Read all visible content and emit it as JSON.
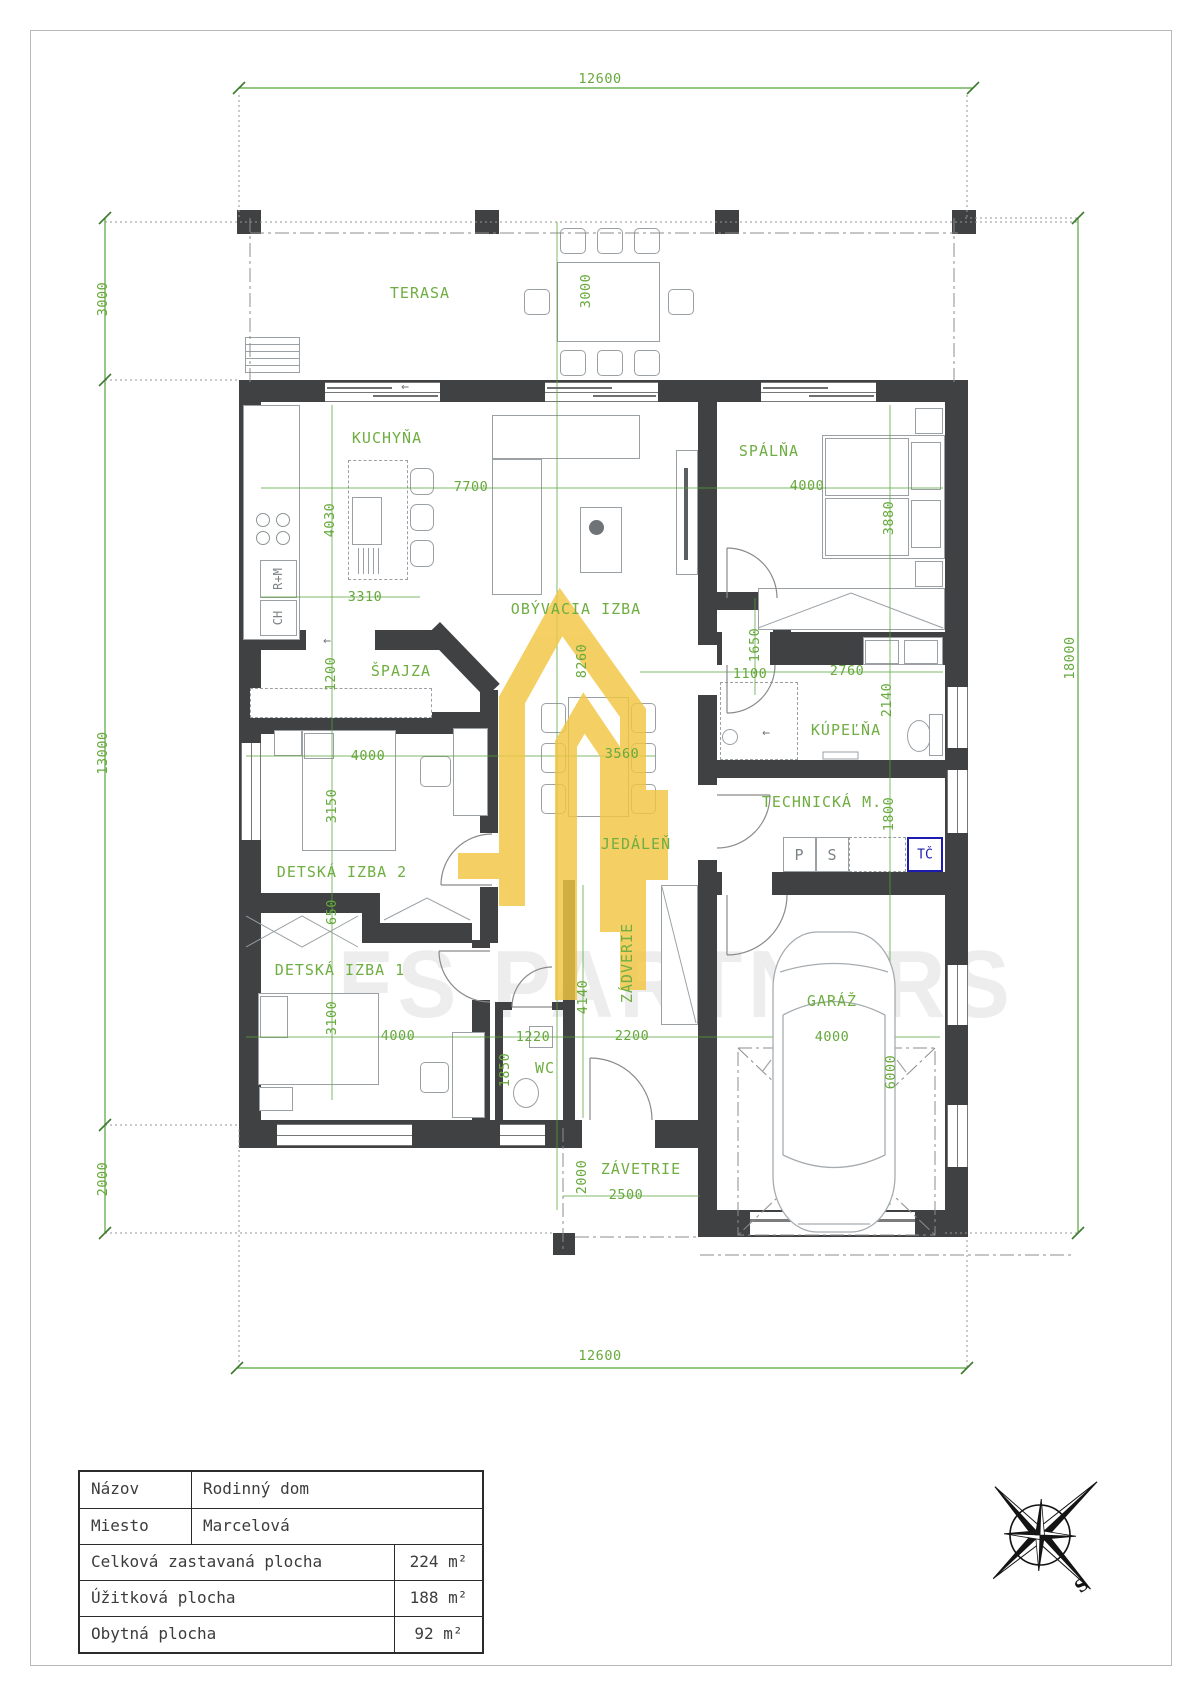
{
  "colors": {
    "wall": "#3f4142",
    "label_green": "#6fae42",
    "dim_green": "#55a339",
    "accent_blue": "#1b1bb0",
    "watermark_yellow": "#f2c643"
  },
  "watermark": {
    "text": "FS PARTNERS"
  },
  "icons": {
    "arrow_left": "←"
  },
  "plan": {
    "rooms": [
      {
        "name": "terasa",
        "label": "TERASA",
        "x": 420,
        "y": 293
      },
      {
        "name": "kuchyna",
        "label": "KUCHYŇA",
        "x": 387,
        "y": 438
      },
      {
        "name": "obyvacia-izba",
        "label": "OBÝVACIA IZBA",
        "x": 576,
        "y": 609
      },
      {
        "name": "spalna",
        "label": "SPÁLŇA",
        "x": 769,
        "y": 451
      },
      {
        "name": "spajza",
        "label": "ŠPAJZA",
        "x": 401,
        "y": 671
      },
      {
        "name": "kupelna",
        "label": "KÚPEĽŇA",
        "x": 846,
        "y": 730
      },
      {
        "name": "detska-izba-2",
        "label": "DETSKÁ IZBA 2",
        "x": 342,
        "y": 872
      },
      {
        "name": "jedalen",
        "label": "JEDÁLEŇ",
        "x": 636,
        "y": 844
      },
      {
        "name": "technicka-m",
        "label": "TECHNICKÁ M.",
        "x": 822,
        "y": 802
      },
      {
        "name": "detska-izba-1",
        "label": "DETSKÁ IZBA 1",
        "x": 340,
        "y": 970
      },
      {
        "name": "wc",
        "label": "WC",
        "x": 545,
        "y": 1068
      },
      {
        "name": "zadverie",
        "label": "ZÁDVERIE",
        "x": 627,
        "y": 963,
        "rot": 1
      },
      {
        "name": "garaz",
        "label": "GARÁŽ",
        "x": 832,
        "y": 1001
      },
      {
        "name": "zavetrie",
        "label": "ZÁVETRIE",
        "x": 641,
        "y": 1169
      }
    ],
    "dims": [
      {
        "t": "12600",
        "x": 600,
        "y": 79
      },
      {
        "t": "12600",
        "x": 600,
        "y": 1356
      },
      {
        "t": "18000",
        "x": 1070,
        "y": 658,
        "rot": 1
      },
      {
        "t": "3000",
        "x": 103,
        "y": 299,
        "rot": 1
      },
      {
        "t": "13000",
        "x": 103,
        "y": 753,
        "rot": 1
      },
      {
        "t": "2000",
        "x": 103,
        "y": 1179,
        "rot": 1
      },
      {
        "t": "3000",
        "x": 586,
        "y": 291,
        "rot": 1
      },
      {
        "t": "7700",
        "x": 471,
        "y": 487
      },
      {
        "t": "4030",
        "x": 330,
        "y": 520,
        "rot": 1
      },
      {
        "t": "3310",
        "x": 365,
        "y": 597
      },
      {
        "t": "4000",
        "x": 807,
        "y": 486
      },
      {
        "t": "3880",
        "x": 889,
        "y": 518,
        "rot": 1
      },
      {
        "t": "1200",
        "x": 331,
        "y": 674,
        "rot": 1
      },
      {
        "t": "8260",
        "x": 582,
        "y": 661,
        "rot": 1
      },
      {
        "t": "1650",
        "x": 755,
        "y": 645,
        "rot": 1
      },
      {
        "t": "1100",
        "x": 750,
        "y": 674
      },
      {
        "t": "2760",
        "x": 847,
        "y": 671
      },
      {
        "t": "2140",
        "x": 887,
        "y": 700,
        "rot": 1
      },
      {
        "t": "4000",
        "x": 368,
        "y": 756
      },
      {
        "t": "3150",
        "x": 332,
        "y": 806,
        "rot": 1
      },
      {
        "t": "3560",
        "x": 622,
        "y": 754
      },
      {
        "t": "1800",
        "x": 889,
        "y": 814,
        "rot": 1
      },
      {
        "t": "650",
        "x": 332,
        "y": 912,
        "rot": 1
      },
      {
        "t": "3100",
        "x": 332,
        "y": 1018,
        "rot": 1
      },
      {
        "t": "4000",
        "x": 398,
        "y": 1036
      },
      {
        "t": "1220",
        "x": 533,
        "y": 1037
      },
      {
        "t": "1850",
        "x": 505,
        "y": 1070,
        "rot": 1
      },
      {
        "t": "4140",
        "x": 583,
        "y": 997,
        "rot": 1
      },
      {
        "t": "2200",
        "x": 632,
        "y": 1036
      },
      {
        "t": "4000",
        "x": 832,
        "y": 1037
      },
      {
        "t": "6000",
        "x": 891,
        "y": 1072,
        "rot": 1
      },
      {
        "t": "2500",
        "x": 626,
        "y": 1195
      },
      {
        "t": "2000",
        "x": 582,
        "y": 1177,
        "rot": 1
      }
    ],
    "appliances": {
      "fridge": "R+M",
      "freezer": "CH",
      "washer": "P",
      "dryer": "S",
      "heat_pump": "TČ"
    }
  },
  "title_block": {
    "rows": [
      {
        "label": "Názov",
        "value": "Rodinný dom"
      },
      {
        "label": "Miesto",
        "value": "Marcelová"
      },
      {
        "label": "Celková zastavaná plocha",
        "value": "224 m²"
      },
      {
        "label": "Úžitková plocha",
        "value": "188 m²"
      },
      {
        "label": "Obytná plocha",
        "value": "92 m²"
      }
    ]
  },
  "compass": {
    "south": "S"
  }
}
